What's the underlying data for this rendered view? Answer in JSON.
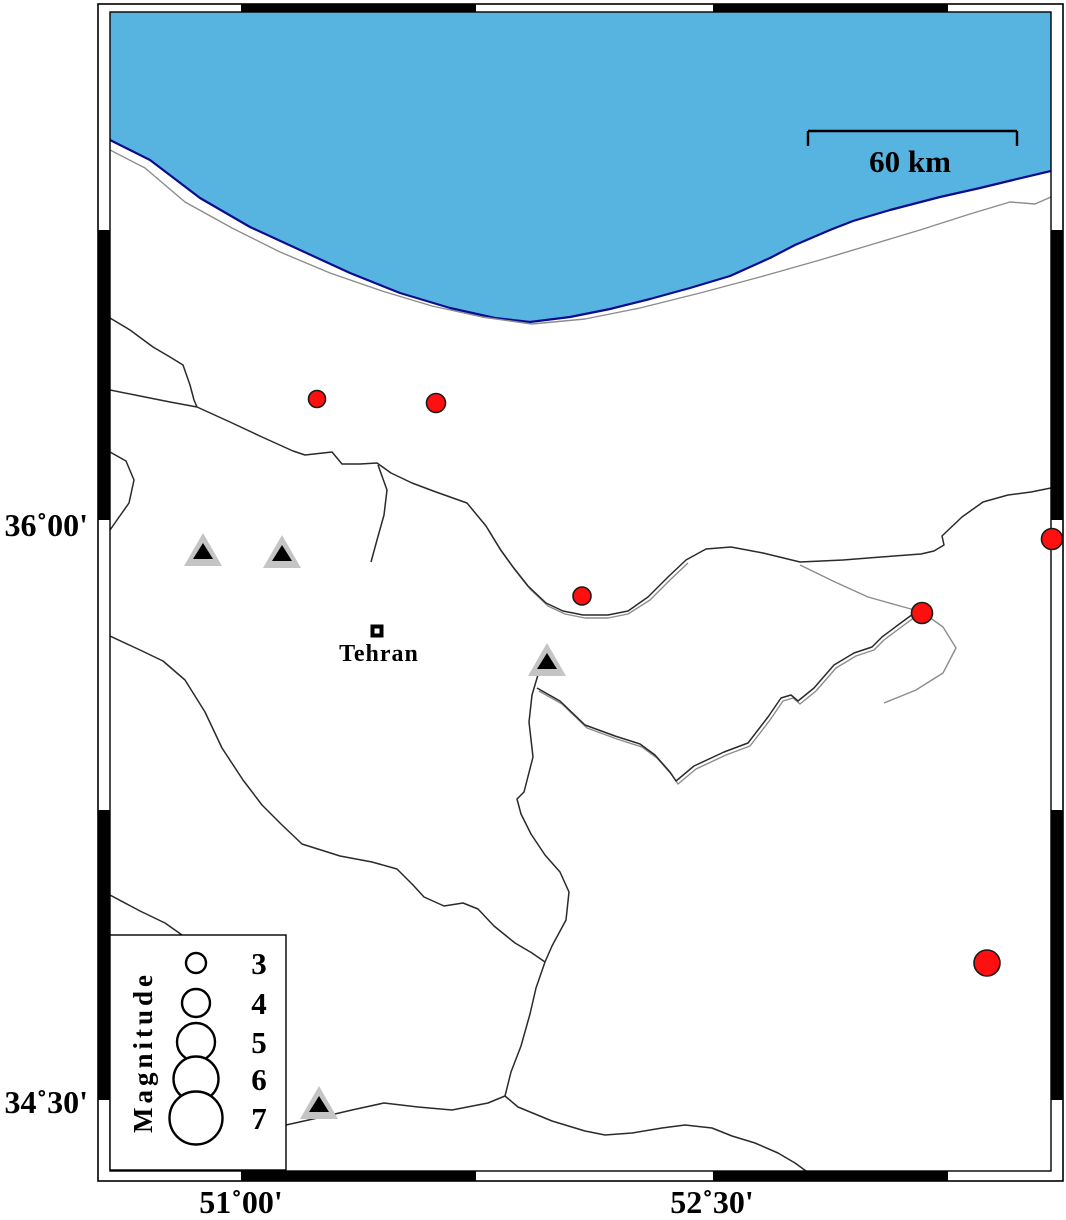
{
  "colors": {
    "sea": "#57B3E0",
    "coast": "#0b0b8f",
    "fault": "#2a2a2a",
    "gray_line": "#8c8c8c",
    "quake_fill": "#ff0f0f",
    "quake_stroke": "#1a1a1a",
    "volcano_outer": "#c4c4c4",
    "volcano_inner": "#000000",
    "frame_black": "#000000"
  },
  "axis": {
    "lat_labels": [
      {
        "text": "36˚00'",
        "value": "36N00"
      },
      {
        "text": "34˚30'",
        "value": "34N30"
      }
    ],
    "lon_labels": [
      {
        "text": "51˚00'",
        "value": "51E00"
      },
      {
        "text": "52˚30'",
        "value": "52E30"
      }
    ]
  },
  "scalebar": {
    "label": "60 km",
    "x1": 808,
    "x2": 1017,
    "y": 131,
    "tick": 15
  },
  "city": {
    "name": "Tehran",
    "x": 377,
    "y": 631,
    "size": 13
  },
  "legend": {
    "title": "Magnitude",
    "box": {
      "x": 110,
      "y": 935,
      "w": 176,
      "h": 235
    },
    "circle_cx": 196,
    "entries": [
      {
        "label": "3",
        "cy": 963,
        "r": 10
      },
      {
        "label": "4",
        "cy": 1003,
        "r": 14
      },
      {
        "label": "5",
        "cy": 1042,
        "r": 19
      },
      {
        "label": "6",
        "cy": 1079,
        "r": 22.5
      },
      {
        "label": "7",
        "cy": 1118,
        "r": 26.5
      }
    ]
  },
  "earthquakes": [
    {
      "x": 317,
      "y": 399,
      "r": 8.5
    },
    {
      "x": 436,
      "y": 403,
      "r": 9.5
    },
    {
      "x": 582,
      "y": 596,
      "r": 9
    },
    {
      "x": 922,
      "y": 613,
      "r": 10.5
    },
    {
      "x": 1052,
      "y": 539,
      "r": 10.5
    },
    {
      "x": 987,
      "y": 963,
      "r": 13
    }
  ],
  "volcanoes": [
    {
      "x": 203,
      "y": 553
    },
    {
      "x": 282,
      "y": 555
    },
    {
      "x": 547,
      "y": 663
    },
    {
      "x": 319,
      "y": 1106
    }
  ],
  "sea": {
    "polygon": "110,12 1051,12 1051,171 1013,180 980,188 940,197 890,210 853,221 830,230 795,245 770,258 730,276 690,288 650,299 610,309 570,317 530,322 495,318 450,308 400,293 350,273 300,250 250,227 200,198 150,160 110,140",
    "coastline": "1051,171 1013,180 980,188 940,197 890,210 853,221 830,230 795,245 770,258 730,276 690,288 650,299 610,309 570,317 530,322 495,318 450,308 400,293 350,273 300,250 250,227 200,198 150,160 110,140"
  },
  "faults": {
    "black": [
      "110,318 130,330 153,347 170,357 183,365 190,385 194,400 197,407",
      "110,390 140,396 170,402 197,407",
      "197,407 230,422 262,437 293,451 305,455 332,452 342,464 360,464 377,463 391,473 412,483 436,492 467,503 486,526 500,549 513,567 528,586 546,603 563,611 583,615 608,615 628,611 648,597 668,577 686,560 706,549 731,547 763,553 800,562 843,560 881,557 921,554 934,551 944,545 942,536 962,517 983,502 1008,495 1031,492 1051,488",
      "378,465 387,490 384,515 377,540 371,562",
      "540,668 532,695 529,722 533,757 524,792 517,799 521,814 531,834 545,855 560,872 569,892 566,920 552,946 545,962 536,988 530,1014 521,1046 511,1072 505,1096",
      "537,688 560,701 585,725 615,736 640,744 655,755 670,772 676,781 694,766 724,752 748,743 768,717 781,698 791,695 798,701 814,688 834,665 854,653 872,647 882,637 898,625 913,614 922,611",
      "110,636 140,650 163,661 185,680 205,712 222,748 243,780 262,805 281,824 302,844 340,856 372,862 397,869 413,885 424,897 444,906 463,903 478,909 494,926 515,943 532,953 545,962",
      "505,1096 488,1103 452,1110 418,1107 384,1103 352,1110 322,1117 286,1125",
      "505,1096 518,1107 552,1121 585,1131 605,1135 632,1133 662,1128 685,1125 712,1128 732,1136 755,1143 778,1153 795,1163 806,1171",
      "110,452 126,461 134,480 129,503 117,520 110,530",
      "110,895 140,911 165,923 182,935"
    ],
    "gray": [
      "110,150 145,168 185,202 232,228 280,252 330,273 382,291 432,306 482,317 532,324 585,319 640,308 700,293 760,277 820,260 870,245 920,230 970,214 1010,202 1035,204 1051,197",
      "539,691 562,704 587,728 617,739 642,747 657,758 672,775 678,784 696,769 726,755 750,746 770,720 783,701 793,698 800,704 816,691 836,668 856,656 874,650 884,640 900,628 915,617 924,614",
      "488,529 502,552 515,570 530,589 548,606 565,614 585,618 608,618 628,614 650,600 670,580 688,563",
      "800,565 835,582 868,597 900,606 922,612 943,627 956,648 943,673 916,690 884,703"
    ]
  },
  "frame": {
    "outer": {
      "x": 98,
      "y": 4,
      "w": 965,
      "h": 1177
    },
    "inner": {
      "x": 110,
      "y": 12,
      "w": 941,
      "h": 1159
    },
    "h_black": [
      [
        241,
        476
      ],
      [
        713,
        948
      ]
    ],
    "v_black": [
      [
        230,
        520
      ],
      [
        810,
        1100
      ]
    ]
  }
}
